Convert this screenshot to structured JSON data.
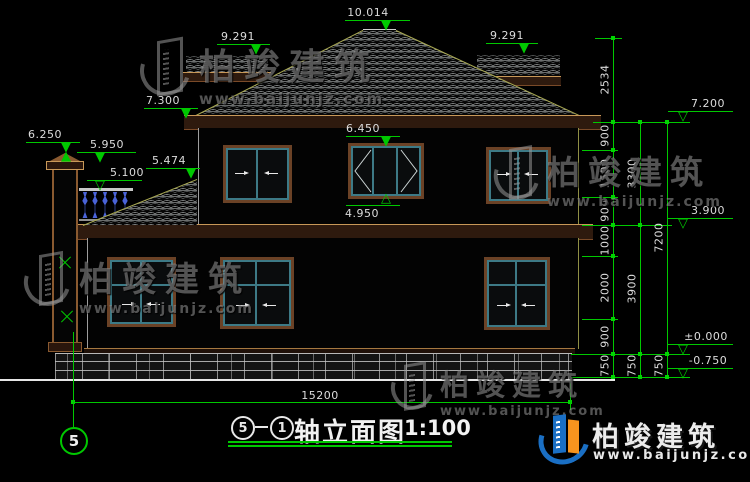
{
  "drawing": {
    "title": {
      "axis_from": "5",
      "axis_to": "1",
      "dash": "",
      "name": "轴立面图",
      "scale": "1:100"
    },
    "axis_bubble": "5",
    "levels": {
      "ridge": "10.014",
      "sub_ridge_left": "9.291",
      "sub_ridge_right": "9.291",
      "eave_left": "7.300",
      "chimney_top": "6.250",
      "chimney_cap": "5.950",
      "porch_roof": "5.474",
      "railing": "5.100",
      "window_head": "6.450",
      "window_sill": "4.950",
      "eave_right": "7.200",
      "floor2": "3.900",
      "zero": "±0.000",
      "grade": "-0.750"
    },
    "chains": {
      "inner": [
        "2534",
        "900",
        "1500",
        "900",
        "1000",
        "2000",
        "900",
        "750"
      ],
      "middle": [
        "3300",
        "3900",
        "750"
      ],
      "outer": [
        "7200",
        "750"
      ]
    },
    "total_width": "15200"
  },
  "brand": {
    "name": "柏竣建筑",
    "site": "www.baijunjz.com"
  },
  "colors": {
    "annotation_green": "#00c800",
    "frame_brown": "#6b4226",
    "sash_teal": "#3d7a86",
    "logo_blue": "#1a6fc4",
    "logo_orange": "#f7941e",
    "baluster_blue": "#4a63d8"
  }
}
